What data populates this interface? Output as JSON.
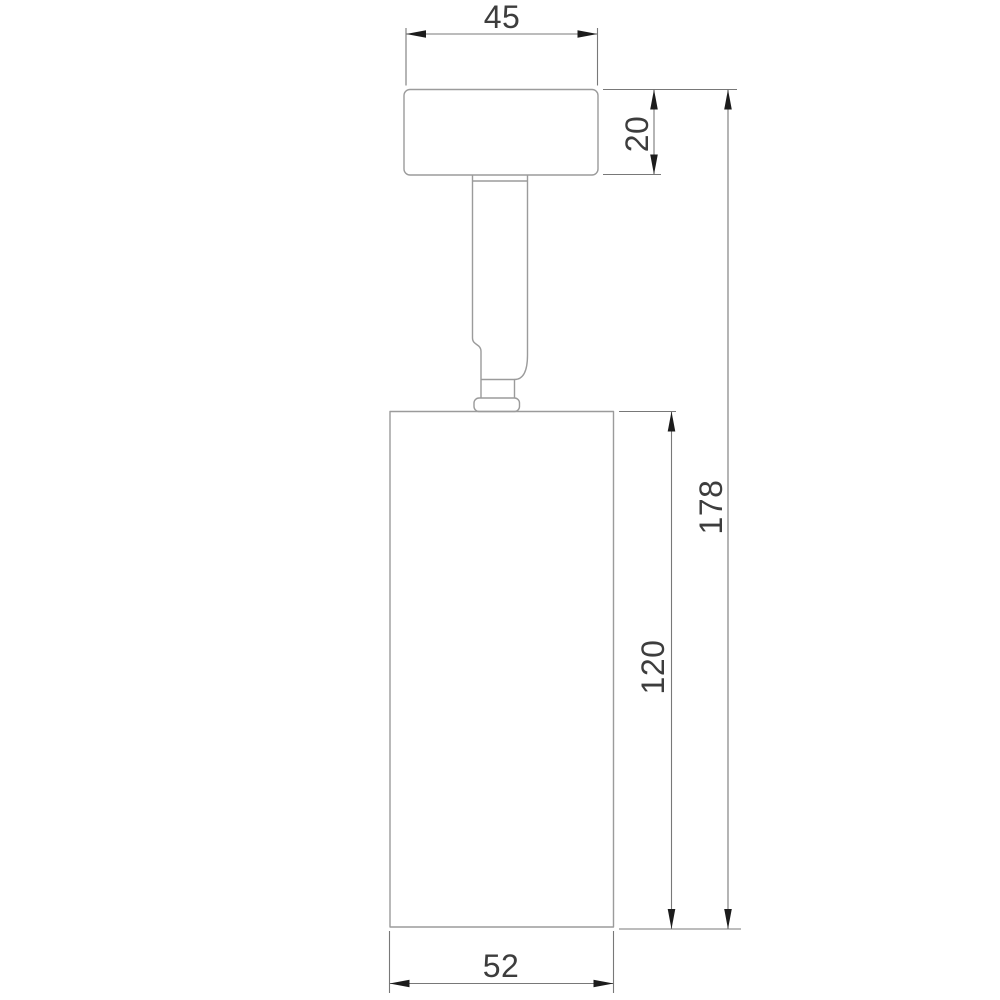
{
  "drawing": {
    "type": "technical-dimension-drawing",
    "subject": "ceiling-spot-light-fixture",
    "dimensions": {
      "canopy_width": {
        "value": "45",
        "orientation": "horizontal",
        "measures": "mounting-canopy-width"
      },
      "canopy_height": {
        "value": "20",
        "orientation": "vertical",
        "measures": "mounting-canopy-height"
      },
      "overall_height": {
        "value": "178",
        "orientation": "vertical",
        "measures": "total-fixture-height"
      },
      "body_height": {
        "value": "120",
        "orientation": "vertical",
        "measures": "lamp-body-height"
      },
      "body_width": {
        "value": "52",
        "orientation": "horizontal",
        "measures": "lamp-body-width"
      }
    },
    "colors": {
      "background": "#ffffff",
      "outline": "#9b9b9b",
      "dimension_line": "#787878",
      "arrow": "#1c1c1c",
      "text": "#3d3d3d"
    }
  }
}
